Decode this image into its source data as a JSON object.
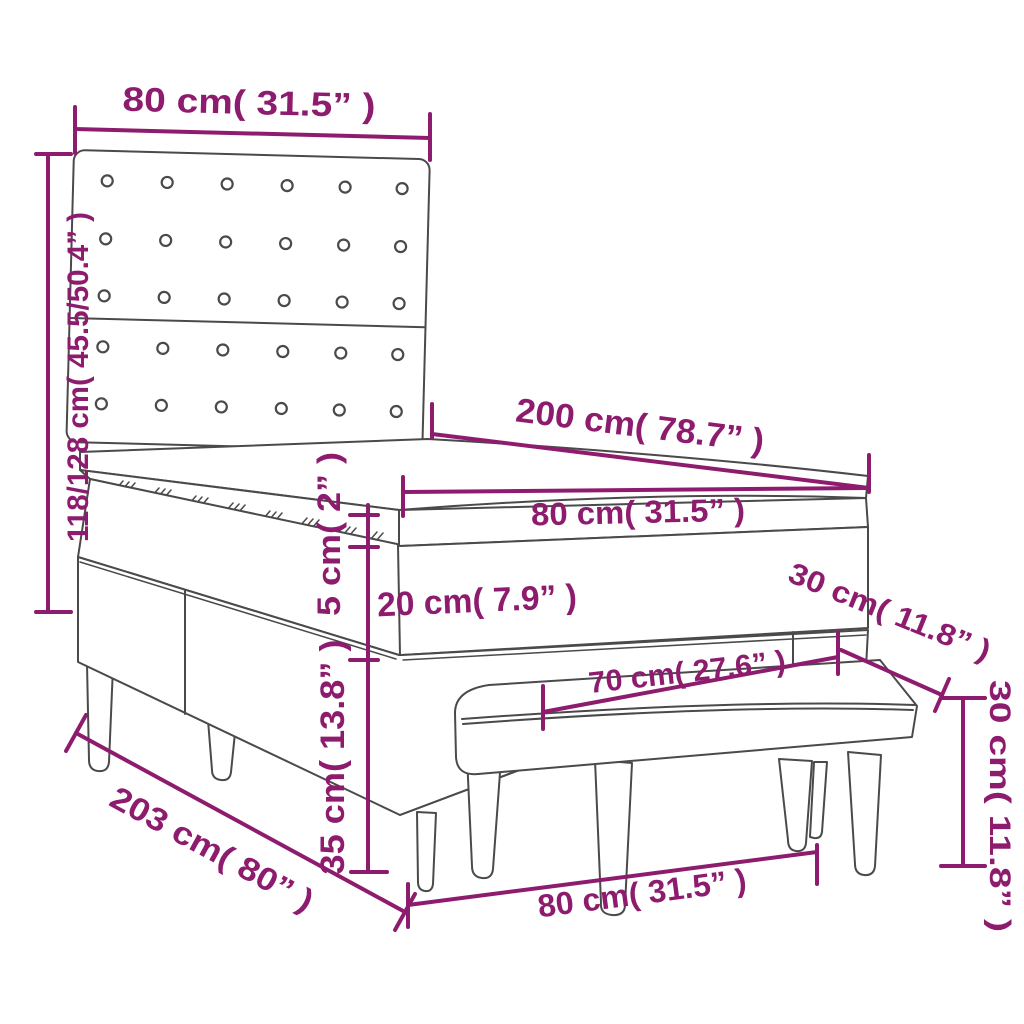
{
  "diagram": {
    "kind": "furniture-dimension-diagram",
    "subject": "box spring bed with buttoned headboard, topper mattress and bench",
    "accent_color": "#8e1c6e",
    "outline_color": "#4a4a4a",
    "background_color": "#ffffff"
  },
  "dims": {
    "headboard_width": {
      "label": "80 cm( 31.5” )"
    },
    "headboard_height": {
      "label": "118/128 cm( 45.5/50.4” )"
    },
    "bed_length": {
      "label": "200 cm( 78.7” )"
    },
    "mattress_width": {
      "label": "80 cm( 31.5” )"
    },
    "topper_thickness": {
      "label": "5 cm( 2” )"
    },
    "mattress_thickness": {
      "label": "20 cm( 7.9” )"
    },
    "base_height": {
      "label": "35 cm( 13.8” )"
    },
    "bench_length": {
      "label": "70 cm( 27.6” )"
    },
    "bench_depth": {
      "label": "30 cm( 11.8” )"
    },
    "bench_height": {
      "label": "30 cm( 11.8” )"
    },
    "total_length": {
      "label": "203 cm( 80” )"
    },
    "bench_width": {
      "label": "80 cm( 31.5” )"
    }
  }
}
